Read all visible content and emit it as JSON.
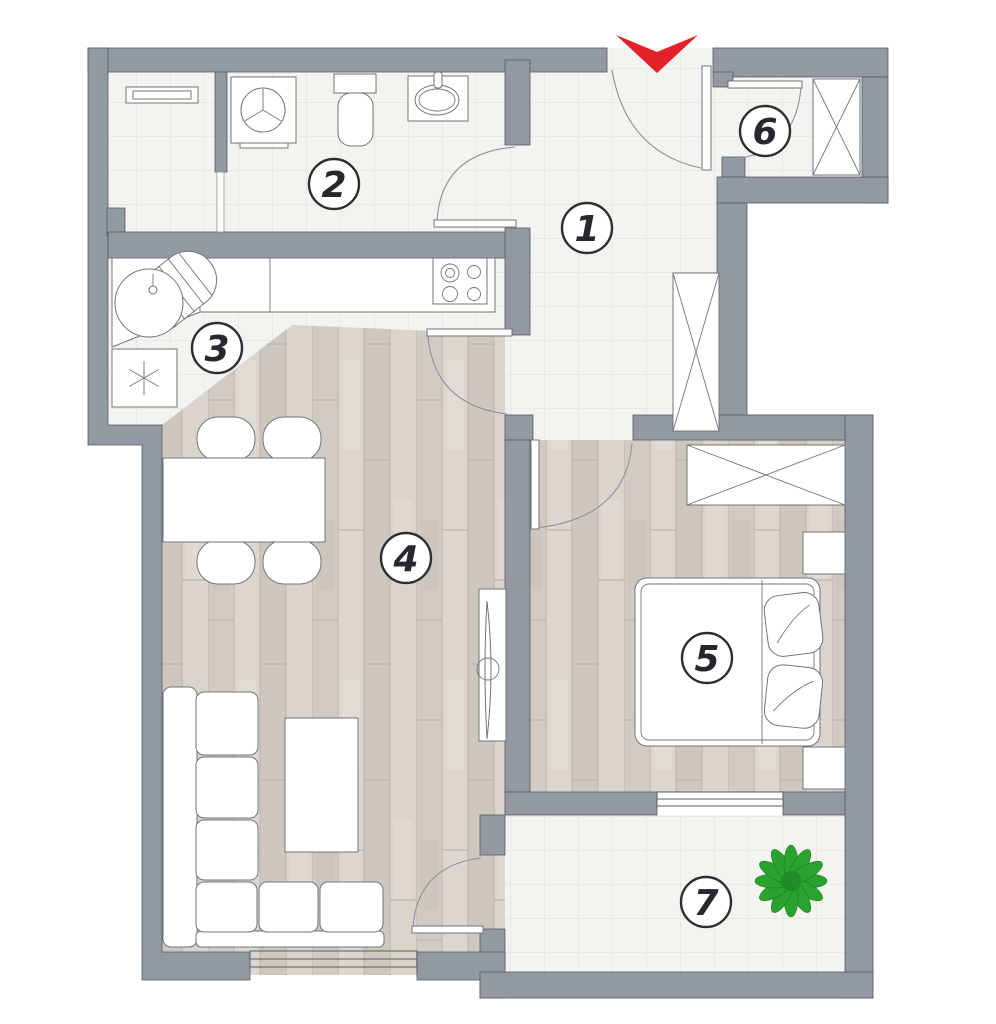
{
  "rooms": [
    {
      "number": "1"
    },
    {
      "number": "2"
    },
    {
      "number": "3"
    },
    {
      "number": "4"
    },
    {
      "number": "5"
    },
    {
      "number": "6"
    },
    {
      "number": "7"
    }
  ],
  "colors": {
    "wall": "#9399a3",
    "entrance_arrow": "#e32128",
    "plant": "#29a22e",
    "plant_dark": "#1f8c25",
    "tile_floor": "#f3f3ef",
    "wood_floor": "#d7d1c9"
  }
}
